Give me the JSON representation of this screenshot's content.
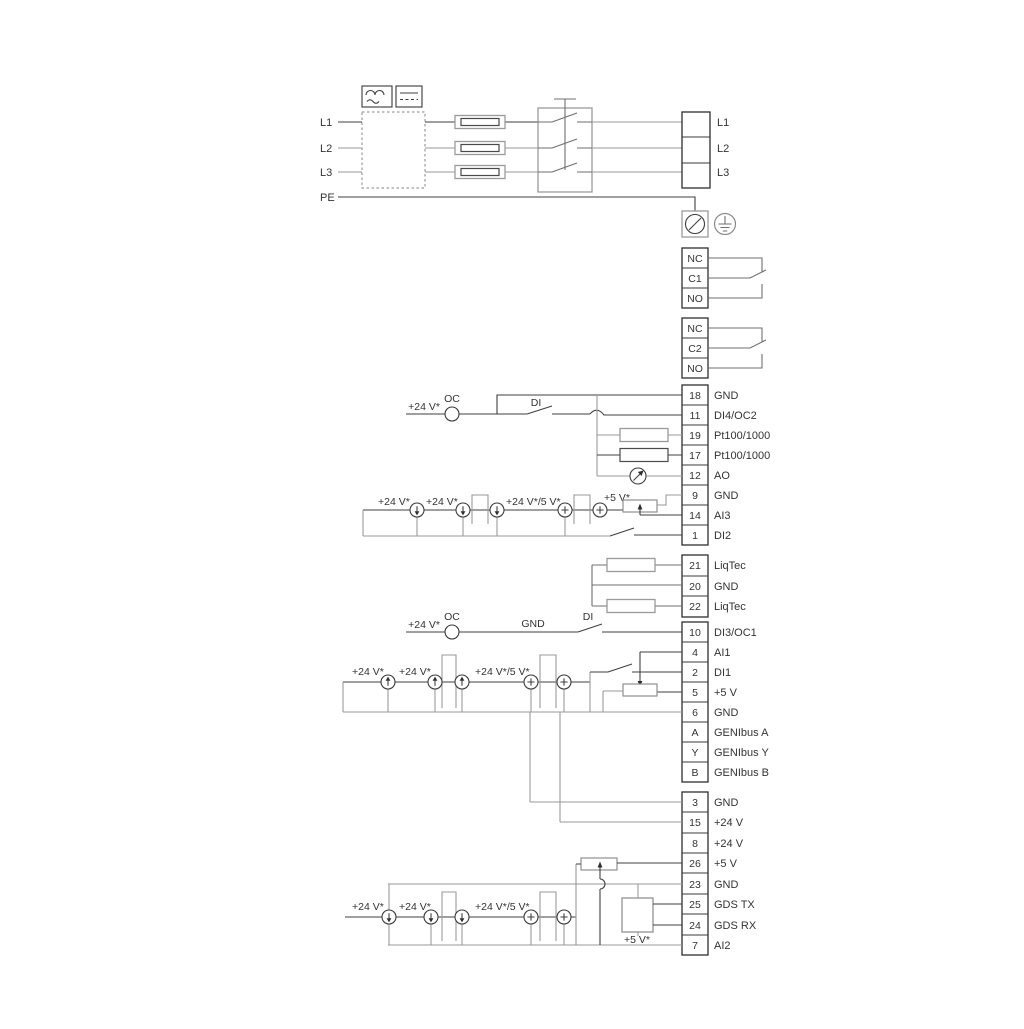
{
  "labels": {
    "v24": "+24 V*",
    "v24v5": "+24 V*/5 V*",
    "v5": "+5 V*",
    "oc": "OC",
    "di": "DI",
    "gnd": "GND"
  },
  "mains": {
    "left": [
      "L1",
      "L2",
      "L3",
      "PE"
    ],
    "right": [
      "L1",
      "L2",
      "L3"
    ]
  },
  "relay1": [
    "NC",
    "C1",
    "NO"
  ],
  "relay2": [
    "NC",
    "C2",
    "NO"
  ],
  "strip1": [
    {
      "no": "18",
      "label": "GND"
    },
    {
      "no": "11",
      "label": "DI4/OC2"
    },
    {
      "no": "19",
      "label": "Pt100/1000"
    },
    {
      "no": "17",
      "label": "Pt100/1000"
    },
    {
      "no": "12",
      "label": "AO"
    },
    {
      "no": "9",
      "label": "GND"
    },
    {
      "no": "14",
      "label": "AI3"
    },
    {
      "no": "1",
      "label": "DI2"
    }
  ],
  "strip2": [
    {
      "no": "21",
      "label": "LiqTec"
    },
    {
      "no": "20",
      "label": "GND"
    },
    {
      "no": "22",
      "label": "LiqTec"
    }
  ],
  "strip3": [
    {
      "no": "10",
      "label": "DI3/OC1"
    },
    {
      "no": "4",
      "label": "AI1"
    },
    {
      "no": "2",
      "label": "DI1"
    },
    {
      "no": "5",
      "label": "+5 V"
    },
    {
      "no": "6",
      "label": "GND"
    },
    {
      "no": "A",
      "label": "GENIbus A"
    },
    {
      "no": "Y",
      "label": "GENIbus Y"
    },
    {
      "no": "B",
      "label": "GENIbus B"
    }
  ],
  "strip4": [
    {
      "no": "3",
      "label": "GND"
    },
    {
      "no": "15",
      "label": "+24 V"
    },
    {
      "no": "8",
      "label": "+24 V"
    },
    {
      "no": "26",
      "label": "+5 V"
    },
    {
      "no": "23",
      "label": "GND"
    },
    {
      "no": "25",
      "label": "GDS TX"
    },
    {
      "no": "24",
      "label": "GDS RX"
    },
    {
      "no": "7",
      "label": "AI2"
    }
  ],
  "colors": {
    "background": "#ffffff",
    "wire_dark": "#3f3f3f",
    "wire_gray": "#9a9a9a",
    "text": "#333333"
  }
}
